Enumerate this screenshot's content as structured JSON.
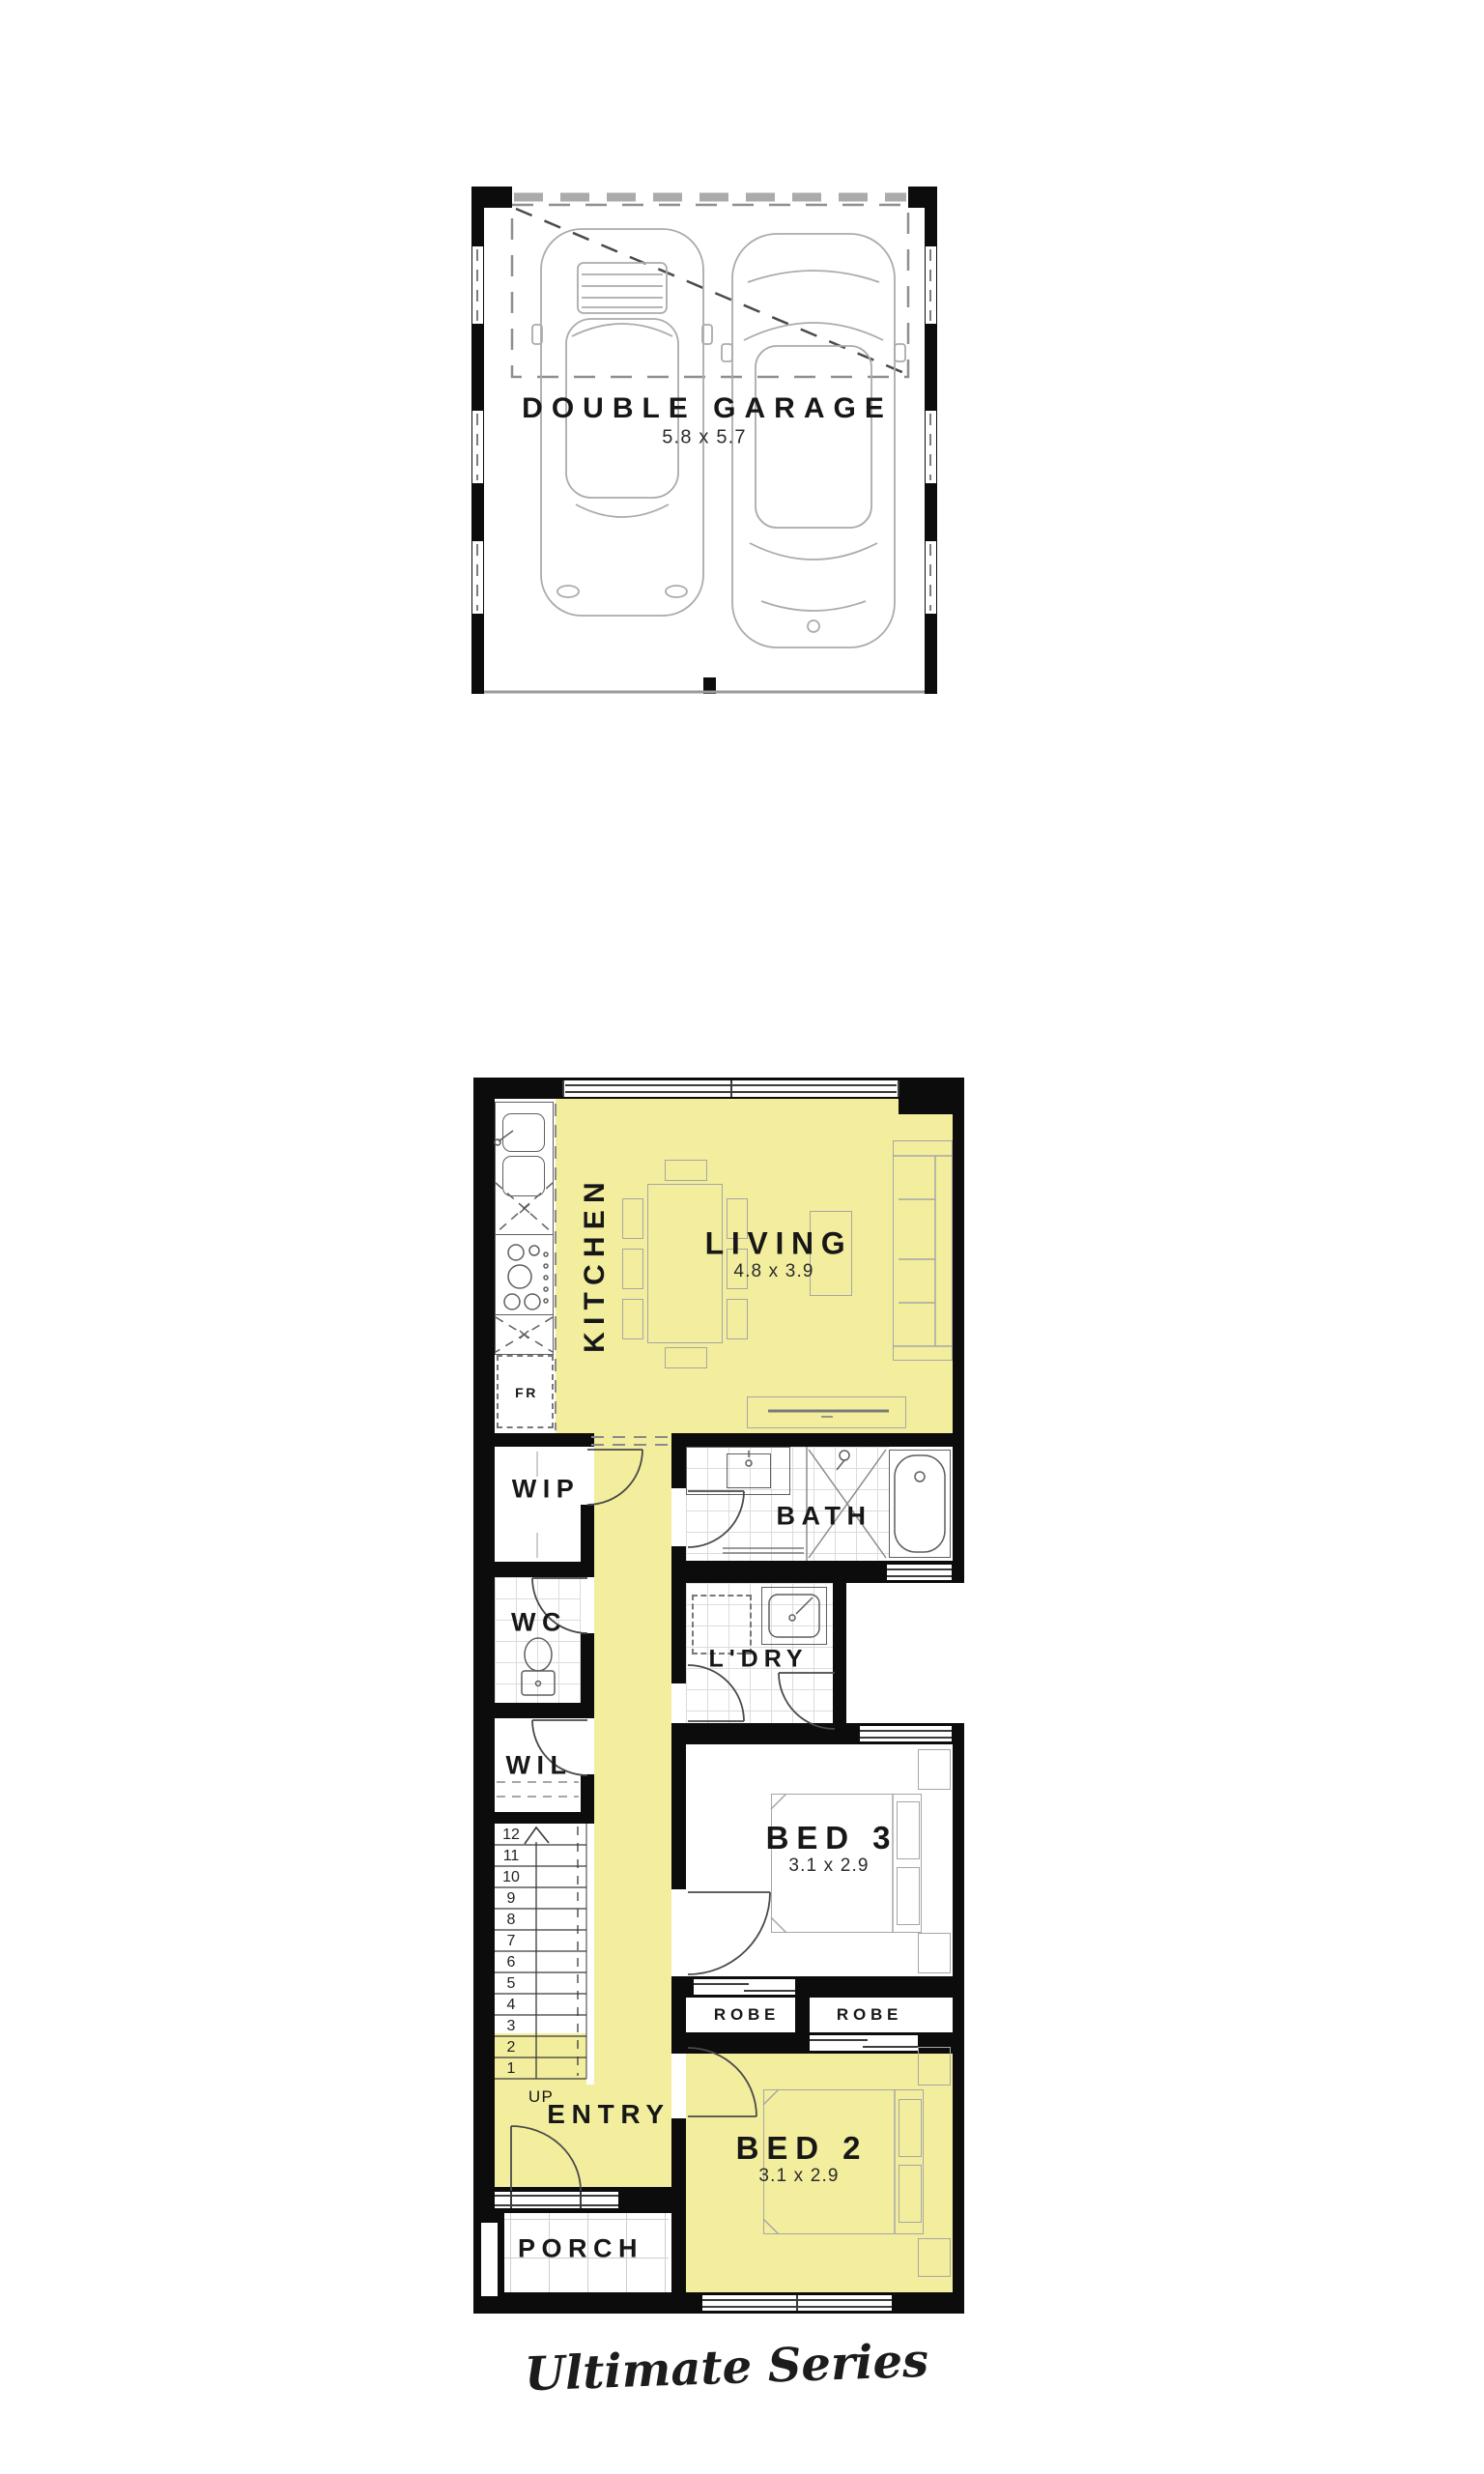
{
  "brand": {
    "series_title": "Ultimate Series"
  },
  "garage": {
    "name": "DOUBLE GARAGE",
    "dimensions": "5.8 x 5.7"
  },
  "floorplan": {
    "kitchen": {
      "name": "KITCHEN"
    },
    "living": {
      "name": "LIVING",
      "dimensions": "4.8 x 3.9"
    },
    "wip": {
      "name": "WIP"
    },
    "wc": {
      "name": "WC"
    },
    "wil": {
      "name": "WIL"
    },
    "bath": {
      "name": "BATH"
    },
    "ldry": {
      "name": "L'DRY"
    },
    "bed3": {
      "name": "BED 3",
      "dimensions": "3.1 x 2.9"
    },
    "robe_left": {
      "name": "ROBE"
    },
    "robe_right": {
      "name": "ROBE"
    },
    "bed2": {
      "name": "BED 2",
      "dimensions": "3.1 x 2.9"
    },
    "entry": {
      "name": "ENTRY"
    },
    "porch": {
      "name": "PORCH"
    },
    "fridge": {
      "name": "FR"
    },
    "up": {
      "name": "UP"
    },
    "stairs": [
      "12",
      "11",
      "10",
      "9",
      "8",
      "7",
      "6",
      "5",
      "4",
      "3",
      "2",
      "1"
    ]
  },
  "colors": {
    "highlight": "#F3EE9E",
    "wall": "#0C0C0C",
    "furniture_line": "#A6A6A6"
  }
}
